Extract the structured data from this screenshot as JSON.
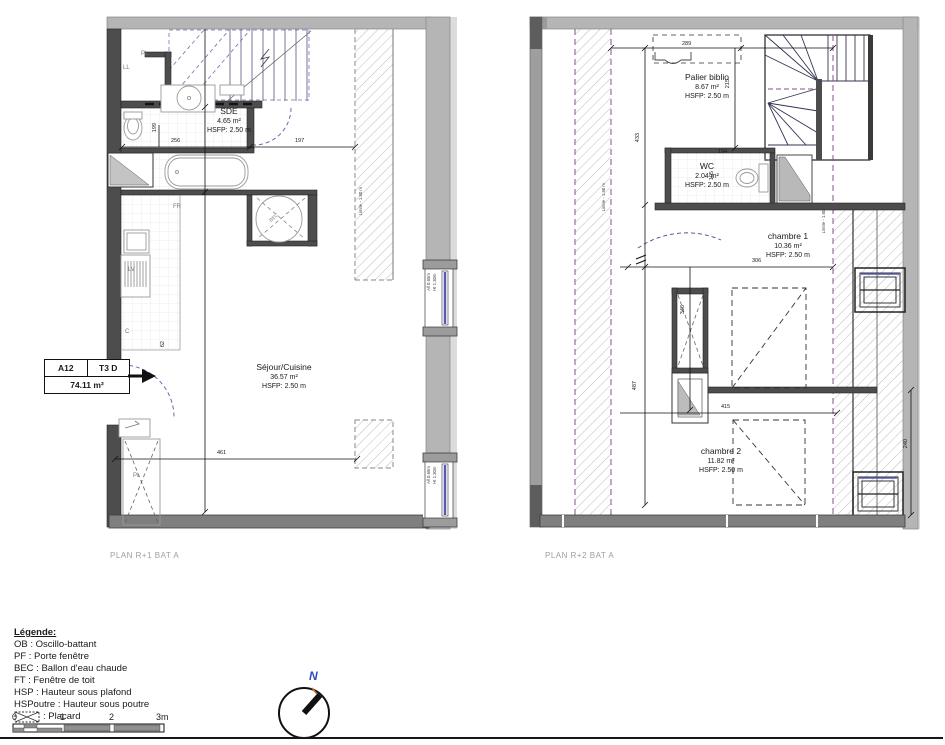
{
  "plans": {
    "r1": {
      "caption": "PLAN R+1 BAT A",
      "unit_box": {
        "code": "A12",
        "type": "T3 D",
        "area": "74.11 m²"
      },
      "rooms": {
        "sde": {
          "name": "SDE",
          "area": "4.65 m²",
          "height": "HSFP: 2.50 m"
        },
        "sejour": {
          "name": "Séjour/Cuisine",
          "area": "36.57 m²",
          "height": "HSFP: 2.50 m"
        }
      },
      "fixtures": {
        "pl_top": "PL",
        "ll": "LL",
        "fr": "FR",
        "lv": "LV",
        "c": "C",
        "bec": "BEC",
        "pl_bottom": "PL"
      },
      "dims": {
        "d256": "256",
        "d197": "197",
        "d199": "199",
        "d62": "62",
        "d461": "461"
      },
      "limit": "Limite - 1.80 m",
      "window": {
        "allege": "All 0.65m",
        "hauteur": "Ht 1.30m"
      }
    },
    "r2": {
      "caption": "PLAN R+2 BAT A",
      "rooms": {
        "palier": {
          "name": "Palier biblio",
          "area": "8.67 m²",
          "height": "HSFP: 2.50 m"
        },
        "wc": {
          "name": "WC",
          "area": "2.04 m²",
          "height": "HSFP: 2.50 m"
        },
        "ch1": {
          "name": "chambre 1",
          "area": "10.36 m²",
          "height": "HSFP: 2.50 m"
        },
        "ch2": {
          "name": "chambre 2",
          "area": "11.82 m²",
          "height": "HSFP: 2.50 m"
        }
      },
      "dims": {
        "d289": "289",
        "d433": "433",
        "d215": "215",
        "d194": "194",
        "d105": "105",
        "d306": "306",
        "d346": "346",
        "d415": "415",
        "d487": "487",
        "d240": "240"
      },
      "limit_left": "Limite - 1.80 m",
      "limit_right": "Limite - 1.80 m"
    }
  },
  "legend": {
    "title": "Légende:",
    "items": [
      "OB : Oscillo-battant",
      "PF : Porte fenêtre",
      "BEC : Ballon d'eau chaude",
      "FT : Fenêtre de toit",
      "HSP : Hauteur sous plafond",
      "HSPoutre : Hauteur sous poutre"
    ],
    "placard_label": ": Placard"
  },
  "scalebar": {
    "t0": "0",
    "t1": "1",
    "t2": "2",
    "t3": "3m"
  },
  "compass": {
    "north": "N"
  },
  "colors": {
    "wall_gray": "#b5b5b5",
    "wall_dark": "#4d4d4d",
    "dash_blue": "#5a5aa8",
    "dash_purple": "#8a4f8a",
    "glazing": "#5b5bb0",
    "caption_gray": "#98a0a2"
  }
}
